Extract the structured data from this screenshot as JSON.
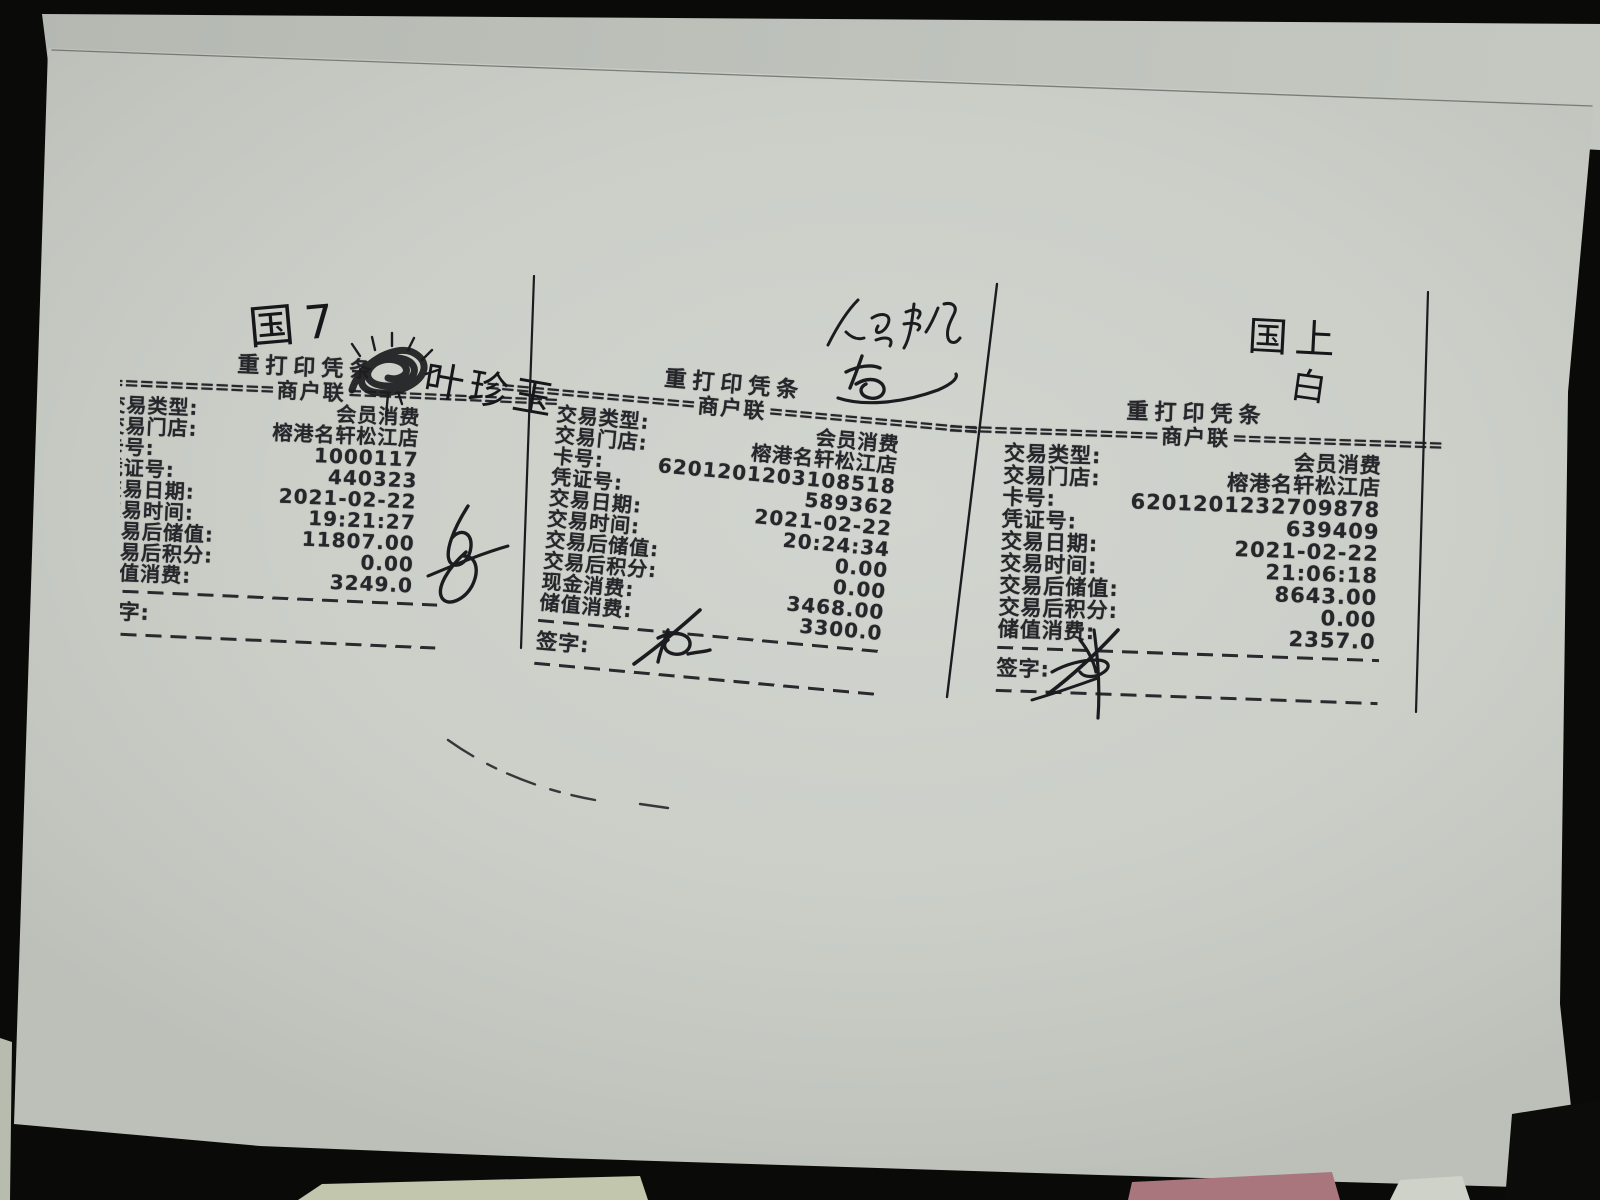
{
  "scene": {
    "background_color": "#0a0a08",
    "paper_color": "#cbcfc8",
    "ink_color": "#26262b"
  },
  "receipts": [
    {
      "title": "重打印凭条",
      "copy_label": "商户联",
      "eq_left": "==============",
      "eq_right": "==============",
      "sign_label": "签字:",
      "rows": [
        {
          "label": "交易类型:",
          "value": "会员消费"
        },
        {
          "label": "交易门店:",
          "value": "榕港名轩松江店"
        },
        {
          "label": "卡号:",
          "value": "1000117"
        },
        {
          "label": "凭证号:",
          "value": "440323"
        },
        {
          "label": "交易日期:",
          "value": "2021-02-22"
        },
        {
          "label": "交易时间:",
          "value": "19:21:27"
        },
        {
          "label": "交易后储值:",
          "value": "11807.00"
        },
        {
          "label": "交易后积分:",
          "value": "0.00"
        },
        {
          "label": "储值消费:",
          "value": "3249.0"
        }
      ]
    },
    {
      "title": "重打印凭条",
      "copy_label": "商户联",
      "eq_left": "==============",
      "eq_right": "==============",
      "sign_label": "签字:",
      "rows": [
        {
          "label": "交易类型:",
          "value": "会员消费"
        },
        {
          "label": "交易门店:",
          "value": "榕港名轩松江店"
        },
        {
          "label": "卡号:",
          "value": "6201201203108518"
        },
        {
          "label": "凭证号:",
          "value": "589362"
        },
        {
          "label": "交易日期:",
          "value": "2021-02-22"
        },
        {
          "label": "交易时间:",
          "value": "20:24:34"
        },
        {
          "label": "交易后储值:",
          "value": "0.00"
        },
        {
          "label": "交易后积分:",
          "value": "0.00"
        },
        {
          "label": "现金消费:",
          "value": "3468.00"
        },
        {
          "label": "储值消费:",
          "value": "3300.0"
        }
      ]
    },
    {
      "title": "重打印凭条",
      "copy_label": "商户联",
      "eq_left": "==============",
      "eq_right": "==============",
      "sign_label": "签字:",
      "rows": [
        {
          "label": "交易类型:",
          "value": "会员消费"
        },
        {
          "label": "交易门店:",
          "value": "榕港名轩松江店"
        },
        {
          "label": "卡号:",
          "value": "6201201232709878"
        },
        {
          "label": "凭证号:",
          "value": "639409"
        },
        {
          "label": "交易日期:",
          "value": "2021-02-22"
        },
        {
          "label": "交易时间:",
          "value": "21:06:18"
        },
        {
          "label": "交易后储值:",
          "value": "8643.00"
        },
        {
          "label": "交易后积分:",
          "value": "0.00"
        },
        {
          "label": "储值消费:",
          "value": "2357.0"
        }
      ]
    }
  ],
  "handwriting": {
    "top_left": "国7",
    "name_note": "叶珍玉",
    "right_top": "国上",
    "right_top_2": "白"
  }
}
